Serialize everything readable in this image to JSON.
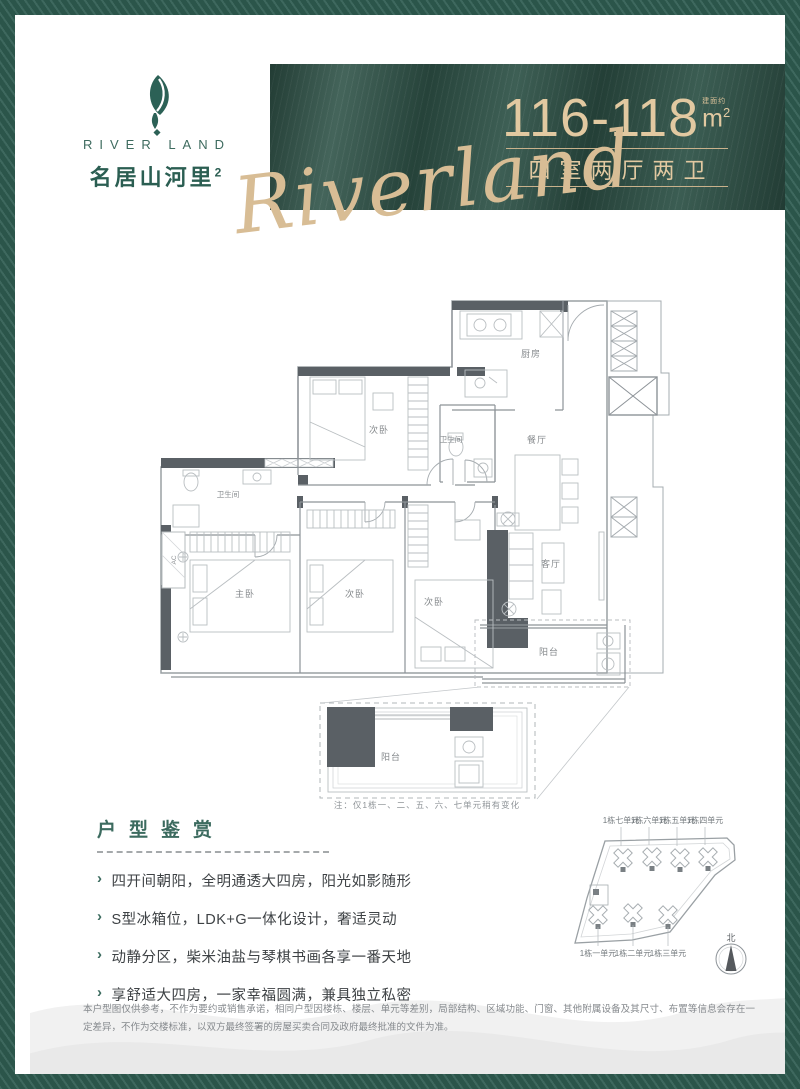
{
  "brand": {
    "en_name": "RIVER LAND",
    "cn_name": "名居山河里",
    "cn_sup": "2",
    "script": "Riverland"
  },
  "banner": {
    "area_value": "116-118",
    "area_prefix": "建面约",
    "unit": "m",
    "unit_sup": "2",
    "layout": "四室两厅两卫"
  },
  "floorplan": {
    "rooms": {
      "kitchen": "厨房",
      "dining": "餐厅",
      "living": "客厅",
      "master": "主卧",
      "bedroom": "次卧",
      "bath": "卫生间",
      "balcony": "阳台",
      "ac": "AC"
    },
    "note": "注：仅1栋一、二、五、六、七单元稍有变化"
  },
  "appreciation": {
    "title": "户型鉴赏",
    "bullet": "›",
    "items": [
      "四开间朝阳，全明通透大四房，阳光如影随形",
      "S型冰箱位，LDK+G一体化设计，奢适灵动",
      "动静分区，柴米油盐与琴棋书画各享一番天地",
      "享舒适大四房，一家幸福圆满，兼具独立私密"
    ]
  },
  "siteplan": {
    "top_labels": [
      "1栋七单元",
      "1栋六单元",
      "1栋五单元",
      "1栋四单元"
    ],
    "bottom_labels": [
      "1栋一单元",
      "1栋二单元",
      "1栋三单元"
    ],
    "north": "北"
  },
  "disclaimer": "本户型图仅供参考，不作为要约或销售承诺，相同户型因楼栋、楼层、单元等差别，局部结构、区域功能、门窗、其他附属设备及其尺寸、布置等信息会存在一定差异，不作为交楼标准，以双方最终签署的房屋买卖合同及政府最终批准的文件为准。",
  "colors": {
    "frame_green": "#2e5b50",
    "banner_green": "#2f5348",
    "gold": "#e2c9a1",
    "logo_green": "#2c6156",
    "wall_gray": "#5a6065"
  }
}
